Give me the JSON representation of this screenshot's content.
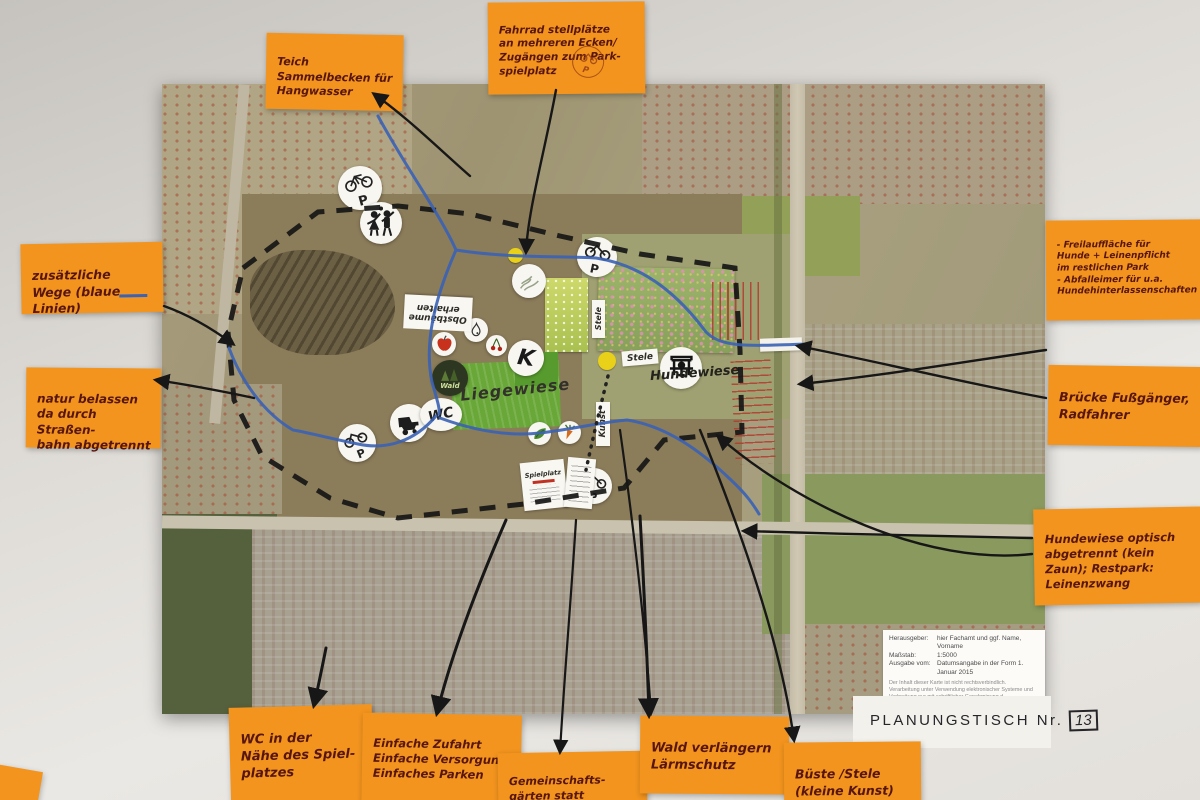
{
  "title_note": {
    "label": "PLANUNGSTISCH Nr.",
    "number": "13"
  },
  "stickies": {
    "fahrrad": {
      "text": "Fahrrad stellplätze\nan mehreren Ecken/\nZugängen zum Park-\nspielplatz"
    },
    "teich": {
      "text": "Teich\nSammelbecken für\nHangwasser"
    },
    "wege": {
      "text": "zusätzliche\nWege (blaue Linien)"
    },
    "natur": {
      "text": "natur belassen\nda durch Straßen-\nbahn abgetrennt"
    },
    "freilauf": {
      "text": "- Freilauffläche für\nHunde + Leinenpflicht\nim restlichen Park\n- Abfalleimer für u.a.\nHundehinterlassenschaften"
    },
    "bruecke": {
      "text": "Brücke Fußgänger,\nRadfahrer"
    },
    "hundewiese": {
      "text": "Hundewiese optisch\nabgetrennt (kein\nZaun); Restpark:\nLeinenzwang"
    },
    "wc": {
      "text": "WC in der\nNähe des Spiel-\nplatzes"
    },
    "einfach": {
      "text": "Einfache Zufahrt\nEinfache Versorgung\nEinfaches Parken"
    },
    "gemeinschaft": {
      "text": "Gemeinschafts-\ngärten statt"
    },
    "wald": {
      "text": "Wald verlängern\nLärmschutz"
    },
    "bueste": {
      "text": "Büste /Stele\n(kleine Kunst)"
    }
  },
  "map": {
    "labels": {
      "liegewiese": "Liegewiese",
      "hundewiese": "Hundewiese",
      "obstbaeume": "Obstbäume\nerhalten",
      "stele": "Stele",
      "stele_vertical": "Stele",
      "kunst": "Kunst",
      "spielplatz": "Spielplatz"
    },
    "sticker_labels": {
      "wc": "WC",
      "k": "K",
      "wald": "Wald",
      "p": "P"
    },
    "icons": {
      "bike_parking": "hand-drawn bicycle above letter P (4 stamps on map, 1 on sticky)",
      "playing_children": "two playing figures with ball",
      "apple": "red apple",
      "pear": "pear outline",
      "cherries": "pair of cherries",
      "letter_k": "marker letter K",
      "wald": "dark forest trees",
      "wc": "WC lettering in oval",
      "cart": "black cart/machine silhouette",
      "leaf": "green leaf scribble",
      "carrot": "carrot",
      "bench": "black bench/seating silhouette",
      "meadow_sketch": "faint meadow pencil sketch",
      "yellow_dot": "small yellow marker dot"
    }
  },
  "legend": {
    "rows": [
      {
        "label": "Herausgeber:",
        "value": "hier Fachamt und ggf. Name, Vorname"
      },
      {
        "label": "Maßstab:",
        "value": "1:5000"
      },
      {
        "label": "Ausgabe vom:",
        "value": "Datumsangabe in der Form 1. Januar 2015"
      }
    ],
    "disclaimer": "Der Inhalt dieser Karte ist nicht rechtsverbindlich.\nVerarbeitung unter Verwendung elektronischer Systeme und Verbreitung nur mit schriftlicher Genehmigung d. Herausgebers. Die analoge Vervielfältigung u. Weitergabe für eigene, nicht gewerbliche Zwecke ist gestattet."
  },
  "colors": {
    "sticky_orange": "#f2941e",
    "handwriting_ink": "#57150f",
    "path_blue": "#3a62b5",
    "boundary_black": "#161616",
    "hatch_red": "#b23a2e",
    "wall": "#dedbd6"
  }
}
